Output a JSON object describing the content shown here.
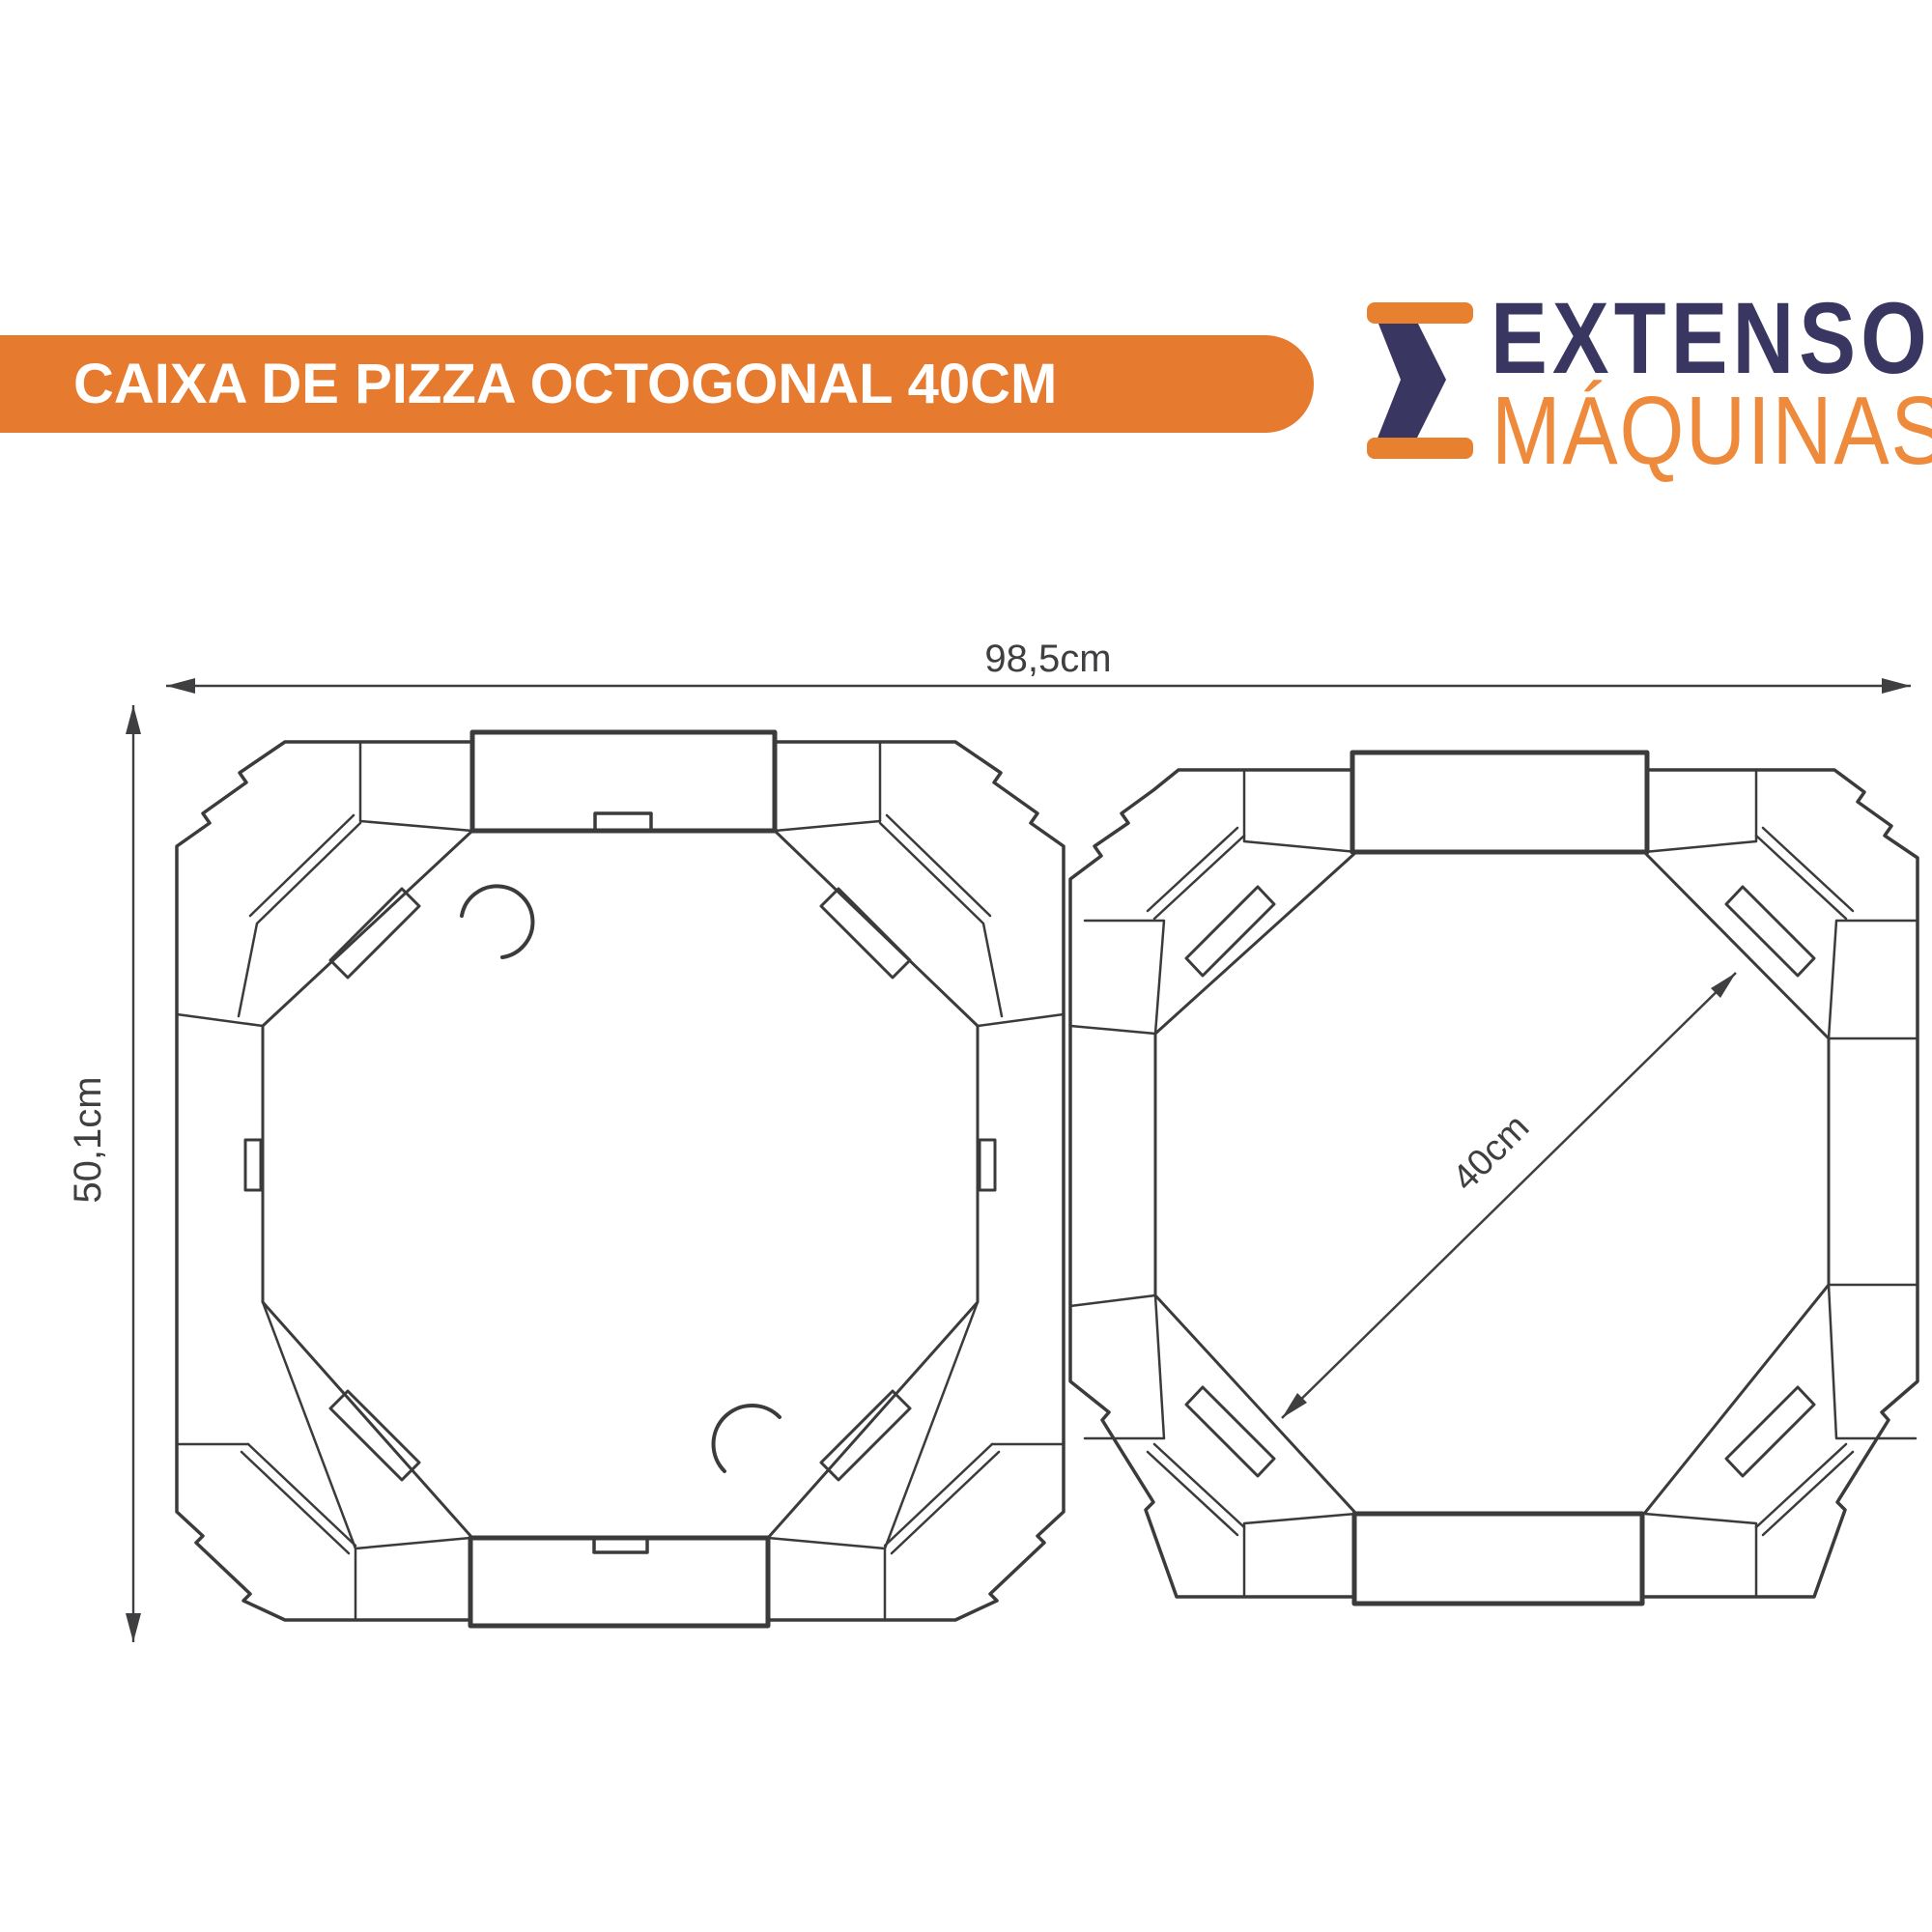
{
  "header": {
    "title": "CAIXA DE PIZZA OCTOGONAL 40CM"
  },
  "logo": {
    "line1": "EXTENSO",
    "line2": "MÁQUINAS"
  },
  "diagram": {
    "total_width_label": "98,5cm",
    "total_height_label": "50,1cm",
    "pizza_diameter_label": "40cm"
  },
  "colors": {
    "accent_orange": "#E67A2E",
    "logo_navy": "#3A3662",
    "logo_orange": "#EE8A3C",
    "line_gray": "#3B3B3D"
  }
}
